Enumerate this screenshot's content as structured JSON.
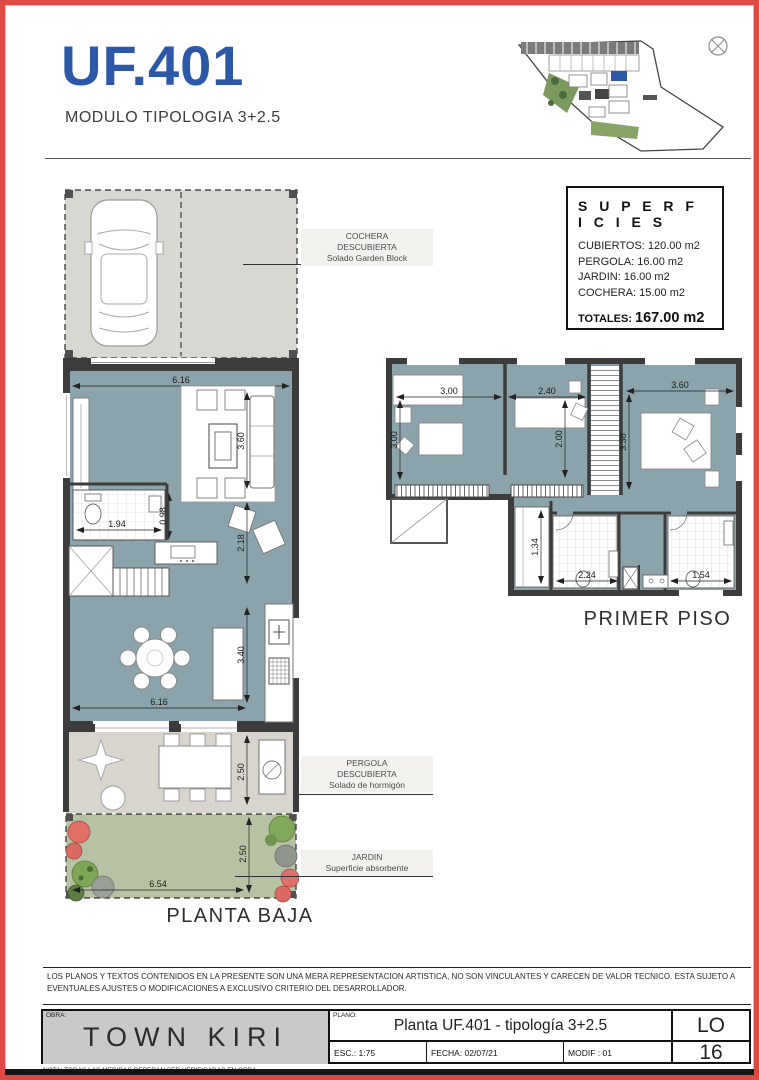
{
  "colors": {
    "accent_blue": "#2d57a7",
    "border_red": "#de4a43",
    "floor_blue": "#8ba3aa",
    "paving_gray": "#d9d7d1",
    "garden_green": "#b7c2a4"
  },
  "header": {
    "unit": "UF.401",
    "subtitle": "MODULO TIPOLOGIA 3+2.5"
  },
  "superficies": {
    "title": "S U P E R F I C I E S",
    "items": [
      "CUBIERTOS: 120.00 m2",
      "PERGOLA: 16.00 m2",
      "JARDIN: 16.00 m2",
      "COCHERA: 15.00 m2"
    ],
    "total_label": "TOTALES:",
    "total_value": "167.00 m2"
  },
  "annotations": {
    "cochera": [
      "COCHERA",
      "DESCUBIERTA",
      "Solado Garden Block"
    ],
    "pergola": [
      "PERGOLA",
      "DESCUBIERTA",
      "Solado de hormigón"
    ],
    "jardin": [
      "JARDIN",
      "Superficie absorbente"
    ]
  },
  "planta_baja": {
    "label": "PLANTA BAJA",
    "dims": {
      "w_top": "6.16",
      "living_h": "3.60",
      "pass": "2.18",
      "bath_w": "1.94",
      "bath_h": "0.98",
      "dining_h": "3.40",
      "w_bottom": "6.16",
      "pergola_h": "2.50",
      "jardin_h": "2.50",
      "jardin_w": "6.54"
    }
  },
  "primer_piso": {
    "label": "PRIMER PISO",
    "dims": {
      "bed1_w": "3.00",
      "bed1_h": "3.00",
      "bed2_w": "2.40",
      "bed2_h": "2.00",
      "bed3_w": "3.60",
      "bed3_h": "3.38",
      "closet_h": "1.34",
      "bath1_w": "2.24",
      "bath2_w": "1.54"
    }
  },
  "disclaimer": "LOS PLANOS Y TEXTOS CONTENIDOS EN LA PRESENTE SON UNA MERA REPRESENTACION ARTISTICA, NO SON VINCULANTES Y CARECEN DE VALOR TECNICO. ESTA SUJETO A EVENTUALES AJUSTES O MODIFICACIONES A EXCLUSIVO CRITERIO DEL DESARROLLADOR.",
  "titleblock": {
    "obra_label": "OBRA:",
    "obra": "TOWN KIRI",
    "plano_label": "PLANO:",
    "plano": "Planta UF.401 - tipología 3+2.5",
    "esc": "ESC.: 1:75",
    "fecha": "FECHA: 02/07/21",
    "modif": "MODIF : 01",
    "sheet_top": "LO",
    "sheet_bottom": "16"
  },
  "footnote": "NOTA: TODAS LAS MEDIDAS DEBERAN SER VERIFICADAS EN OBRA."
}
